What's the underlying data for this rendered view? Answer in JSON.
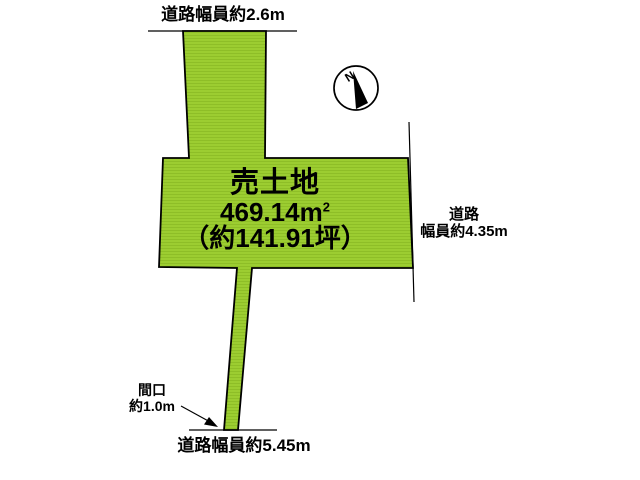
{
  "diagram": {
    "parcel": {
      "title": "売土地",
      "area_value": "469.14m",
      "area_exponent": "2",
      "area_tsubo": "（約141.91坪）",
      "fill_color": "#9ccd31",
      "stripe_color": "#8ebe27"
    },
    "roads": {
      "top": "道路幅員約2.6m",
      "right_line1": "道路",
      "right_line2": "幅員約4.35m",
      "bottom": "道路幅員約5.45m"
    },
    "frontage": {
      "line1": "間口",
      "line2": "約1.0m"
    },
    "compass": {
      "north": "N"
    },
    "colors": {
      "outline": "#000000",
      "background": "#ffffff",
      "text": "#000000"
    }
  }
}
